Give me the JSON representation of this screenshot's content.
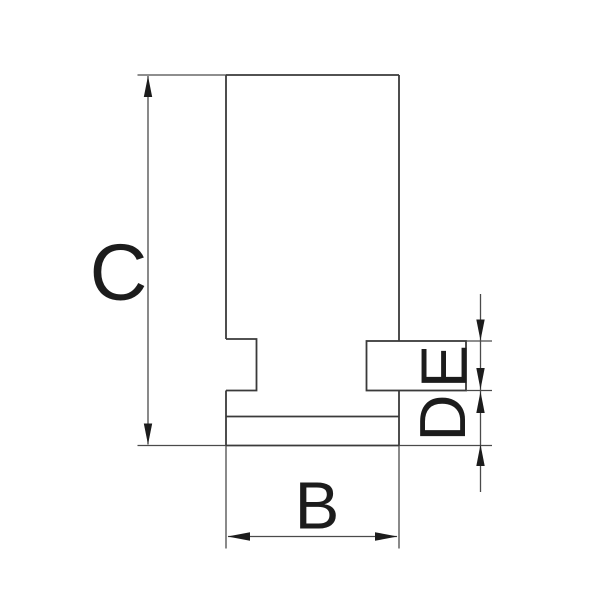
{
  "diagram": {
    "type": "technical-drawing",
    "background_color": "#ffffff",
    "outline_color": "#3a3a3a",
    "dimension_line_color": "#4a4a4a",
    "label_color": "#1c1c1c",
    "labels": {
      "c": "C",
      "b": "B",
      "d": "D",
      "e": "E"
    }
  }
}
